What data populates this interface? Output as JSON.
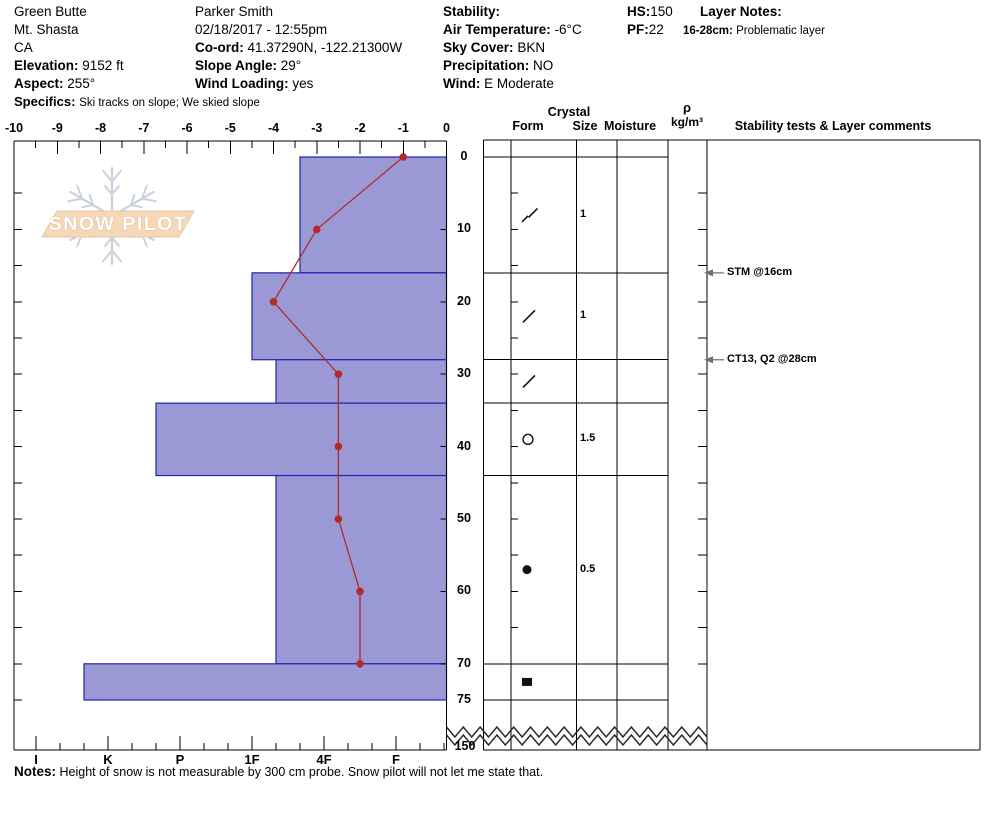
{
  "site": {
    "name": "Green Butte",
    "region": "Mt. Shasta",
    "state": "CA",
    "elevation_label": "Elevation:",
    "elevation_value": "9152 ft",
    "aspect_label": "Aspect:",
    "aspect_value": "255°",
    "specifics_label": "Specifics:",
    "specifics_value": "Ski tracks on slope; We skied slope"
  },
  "observer": {
    "name": "Parker Smith",
    "datetime": "02/18/2017 - 12:55pm",
    "coord_label": "Co-ord:",
    "coord_value": "41.37290N, -122.21300W",
    "slope_angle_label": "Slope Angle:",
    "slope_angle_value": "29°",
    "wind_loading_label": "Wind Loading:",
    "wind_loading_value": "yes"
  },
  "conditions": {
    "stability_label": "Stability:",
    "stability_value": "",
    "air_temp_label": "Air Temperature:",
    "air_temp_value": "-6°C",
    "sky_label": "Sky Cover:",
    "sky_value": "BKN",
    "precip_label": "Precipitation:",
    "precip_value": "NO",
    "wind_label": "Wind:",
    "wind_value": "E Moderate"
  },
  "totals": {
    "hs_label": "HS:",
    "hs_value": "150",
    "pf_label": "PF:",
    "pf_value": "22"
  },
  "layer_notes": {
    "title": "Layer Notes:",
    "entries": [
      {
        "range": "16-28cm:",
        "text": "Problematic layer"
      }
    ]
  },
  "logo": {
    "text": "SNOW PILOT"
  },
  "table": {
    "headers": {
      "crystal": "Crystal",
      "form": "Form",
      "size": "Size",
      "moisture": "Moisture",
      "density_symbol": "ρ",
      "density_units": "kg/m³",
      "stability": "Stability tests & Layer comments"
    }
  },
  "chart_data": {
    "type": "snow-profile",
    "temperature_axis": {
      "unit": "°C",
      "min": -10,
      "max": 0,
      "major_step": 1,
      "minor_step": 0.5
    },
    "depth_axis": {
      "unit": "cm",
      "tick_labels": [
        0,
        10,
        20,
        30,
        40,
        50,
        60,
        70,
        75
      ],
      "break_label": "150",
      "total_depth_cm": 150,
      "minor_step_cm": 5
    },
    "hardness_axis": {
      "tick_labels": [
        "I",
        "K",
        "P",
        "1F",
        "4F",
        "F"
      ]
    },
    "temperature_profile": [
      {
        "depth_cm": 0,
        "temp_c": -1.0
      },
      {
        "depth_cm": 10,
        "temp_c": -3.0
      },
      {
        "depth_cm": 20,
        "temp_c": -4.0
      },
      {
        "depth_cm": 30,
        "temp_c": -2.5
      },
      {
        "depth_cm": 40,
        "temp_c": -2.5
      },
      {
        "depth_cm": 50,
        "temp_c": -2.5
      },
      {
        "depth_cm": 60,
        "temp_c": -2.0
      },
      {
        "depth_cm": 70,
        "temp_c": -2.0
      }
    ],
    "layers": [
      {
        "top_cm": 0,
        "bottom_cm": 16,
        "hardness": "4F+",
        "form_symbol": "slash-pair",
        "crystal_size_mm": "1"
      },
      {
        "top_cm": 16,
        "bottom_cm": 28,
        "hardness": "1F",
        "form_symbol": "slash",
        "crystal_size_mm": "1"
      },
      {
        "top_cm": 28,
        "bottom_cm": 34,
        "hardness": "1F-",
        "form_symbol": "slash",
        "crystal_size_mm": ""
      },
      {
        "top_cm": 34,
        "bottom_cm": 44,
        "hardness": "P+",
        "form_symbol": "open-circle",
        "crystal_size_mm": "1.5"
      },
      {
        "top_cm": 44,
        "bottom_cm": 70,
        "hardness": "1F-",
        "form_symbol": "filled-circle",
        "crystal_size_mm": "0.5"
      },
      {
        "top_cm": 70,
        "bottom_cm": 75,
        "hardness": "K+",
        "form_symbol": "filled-square",
        "crystal_size_mm": ""
      }
    ],
    "annotations": [
      {
        "text": "STM @16cm",
        "depth_cm": 16
      },
      {
        "text": "CT13, Q2 @28cm",
        "depth_cm": 28
      }
    ],
    "colors": {
      "bar_fill": "#9a99d6",
      "bar_border": "#2323b2",
      "temp_line": "#b22a2a"
    }
  },
  "notes": {
    "label": "Notes:",
    "text": "Height of snow is not measurable by 300 cm probe.  Snow pilot will not let me state that."
  }
}
